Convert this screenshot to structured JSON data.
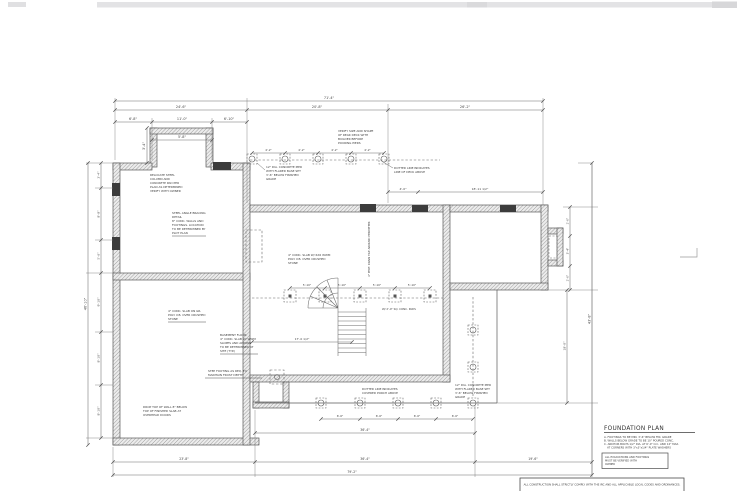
{
  "page": {
    "bg": "#ffffff",
    "top_bar_color": "#e3e3e5",
    "ink": "#4a4a4a"
  },
  "plan": {
    "dims": {
      "top_overall": "71'-4\"",
      "top_row2": [
        "24'-6\"",
        "20'-8\"",
        "26'-2\""
      ],
      "top_row3": [
        "6'-8\"",
        "11'-0\"",
        "6'-10\""
      ],
      "bay_width": "5'-8\"",
      "bay_height": "3'-4\"",
      "pier_top": [
        "4'-2\"",
        "4'-2\"",
        "4'-2\"",
        "4'-2\""
      ],
      "deck_right": [
        "4'-0\"",
        "18'-11 1/2\""
      ],
      "mid_row": [
        "5'-10\"",
        "5'-10\"",
        "5'-10\"",
        "5'-10\""
      ],
      "mid_long": "17'-0 1/2\"",
      "left_outer": "46'-10\"",
      "left_chain": [
        "3'-4\"",
        "8'-8\"",
        "5'-6\"",
        "9'-10\"",
        "8'-10\"",
        "8'-10\""
      ],
      "right_wing_chain": [
        "2'-0\"",
        "3'-4\"",
        "2'-0\""
      ],
      "right_porch": "18'-0\"",
      "right_overall": "43'-8\"",
      "bottom_pier": [
        "6'-6\"",
        "6'-6\"",
        "6'-6\"",
        "6'-6\""
      ],
      "bottom_b2": "36'-4\"",
      "bottom_b3": [
        "23'-8\"",
        "36'-4\"",
        "19'-6\""
      ],
      "bottom_overall": "79'-2\""
    },
    "notes": {
      "a1": [
        "RELOCATE STEEL",
        "COLUMN AND",
        "CONCRETE PAD PER",
        "PLAN AS DETERMINED",
        "VERIFY WITH OWNER"
      ],
      "a2": [
        "STEEL ANGLE BRACING",
        "DETAIL",
        "8\" CONC. WALLS AND",
        "FOOTINGS. LOCATION",
        "TO BE DETERMINED BY",
        "PLOT PLAN"
      ],
      "a3": [
        "4\" CONC. SLAB ON GR.",
        "POLY V.B. OVER CRUSHED",
        "STONE"
      ],
      "a4": [
        "BASEMENT FLOOR",
        "4\" CONC. SLAB W/ WWM",
        "SLOPES AND APRONS",
        "TO BE DETERMINED AT",
        "SITE (TYP.)"
      ],
      "a5": [
        "STEP FOOTING AS REQ. TO",
        "MAINTAIN FROST DEPTH"
      ],
      "a6": [
        "DROP TOP OF WALL 8\" BELOW",
        "TOP OF FINISHED SLAB AT",
        "OVERHEAD DOORS"
      ],
      "a7": [
        "4\" CONC. SLAB W/ 6X6 WWM",
        "POLY V.B. OVER CRUSHED",
        "STONE"
      ],
      "a8": "4\" PERF. DRAIN TILE AROUND PERIMETER",
      "a9": [
        "VERIFY SIZE AND SHAPE",
        "OF REAR DECK WITH",
        "BUILDER BEFORE",
        "POURING PIERS"
      ],
      "a10": [
        "DOTTED LINE INDICATES",
        "LINE OF DECK ABOVE"
      ],
      "a11": [
        "12\" DIA. CONCRETE PIER",
        "WITH FLARED BASE SET",
        "3'-6\" BELOW FINISHED",
        "GRADE"
      ],
      "a12": [
        "12\" DIA. CONCRETE PIER",
        "WITH FLARED BASE SET",
        "3'-6\" BELOW FINISHED",
        "GRADE"
      ],
      "a13": [
        "DOTTED LINE INDICATES",
        "COVERED PORCH ABOVE"
      ],
      "a14": "W/ 2'-0\" SQ. CONC. PADS"
    },
    "title_block": {
      "title": "FOUNDATION PLAN",
      "notes": [
        "A. FOOTINGS TO BE MIN. 3'-6\" BELOW FIN. GRADE",
        "B. WALLS BELOW GRADE TO BE 10\" POURED CONC.",
        "C. ANCHOR BOLTS 1/2\" DIA. AT 6'-0\" O.C. AND 12\" MAX.",
        "AT CORNERS WITH 3\"x3\"x1/4\" PLATE WASHERS"
      ],
      "box_note": [
        "ALL EXCAVATIONS AND FOOTINGS",
        "MUST BE VERIFIED WITH",
        "OWNER"
      ]
    },
    "footer_note": "ALL CONSTRUCTION SHALL STRICTLY COMPLY WITH THE IRC AND ALL APPLICABLE LOCAL CODES AND ORDINANCES."
  }
}
